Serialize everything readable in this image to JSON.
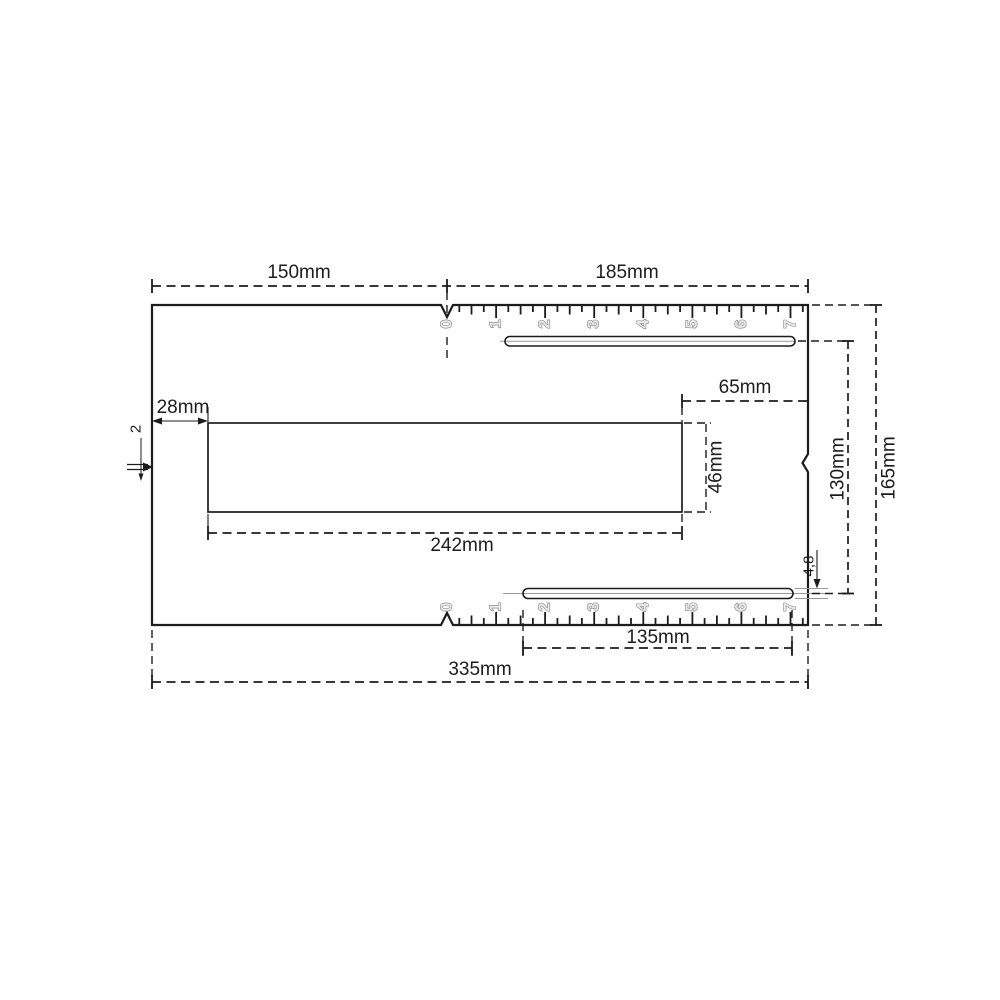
{
  "drawing": {
    "type": "technical-dimension-drawing",
    "units": "mm",
    "labels": {
      "top_width_left": "150mm",
      "top_width_right": "185mm",
      "opening_offset_left": "28mm",
      "opening_length": "242mm",
      "opening_height": "46mm",
      "right_inset": "65mm",
      "slot_spacing": "130mm",
      "total_height": "165mm",
      "bottom_slot_length": "135mm",
      "total_width": "335mm",
      "slot_width": "4,8",
      "edge_detail": "2"
    },
    "rulers": {
      "top": {
        "numbers": [
          "0",
          "1",
          "2",
          "3",
          "4",
          "5",
          "6",
          "7"
        ]
      },
      "bottom": {
        "numbers": [
          "0",
          "1",
          "2",
          "3",
          "4",
          "5",
          "6",
          "7"
        ]
      }
    },
    "colors": {
      "line": "#1c1c1c",
      "ruler_digit_outline": "#7c7c7c",
      "ruler_digit_fill": "#ebebeb",
      "background": "#ffffff"
    }
  }
}
